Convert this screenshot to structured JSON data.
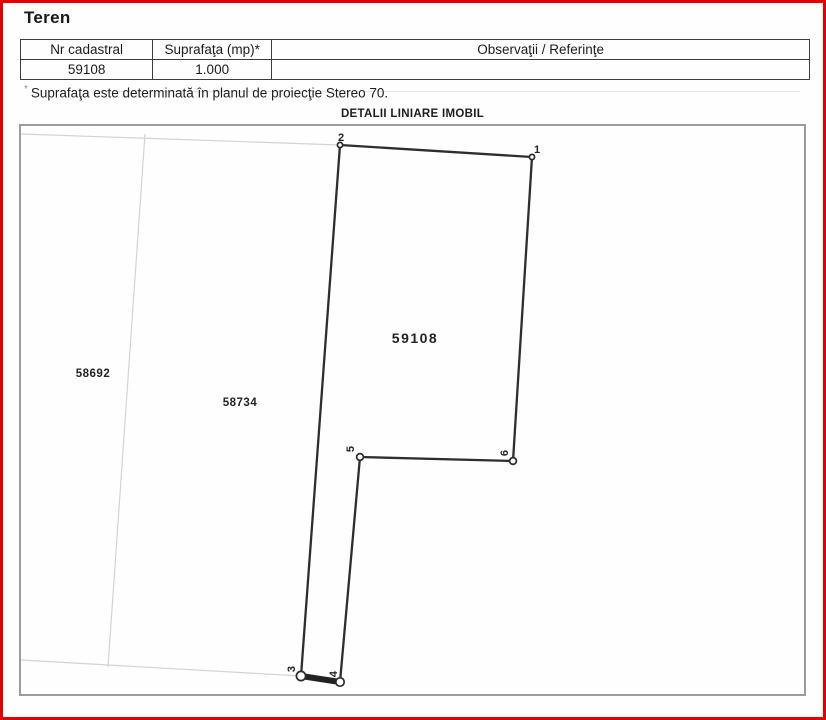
{
  "header": {
    "title": "Teren"
  },
  "table": {
    "headers": [
      "Nr cadastral",
      "Suprafaţa (mp)*",
      "Observaţii / Referinţe"
    ],
    "row": {
      "nr_cadastral": "59108",
      "suprafata": "1.000",
      "observatii": ""
    }
  },
  "footnote": {
    "marker": "*",
    "text": "Suprafaţa este determinată în planul de proiecţie Stereo 70."
  },
  "plan": {
    "title": "DETALII LINIARE IMOBIL",
    "parcel_label": "59108",
    "neighbors": [
      {
        "label": "58692"
      },
      {
        "label": "58734"
      }
    ],
    "vertices": [
      {
        "label": "1"
      },
      {
        "label": "2"
      },
      {
        "label": "3"
      },
      {
        "label": "4"
      },
      {
        "label": "5"
      },
      {
        "label": "6"
      }
    ]
  },
  "colors": {
    "frame_red": "#e00000",
    "boundary_dark": "#2e2e2e",
    "neighbor_faint": "#d3d3d3",
    "plan_border_gray": "#9c9c9c",
    "text": "#1c1c1c"
  }
}
